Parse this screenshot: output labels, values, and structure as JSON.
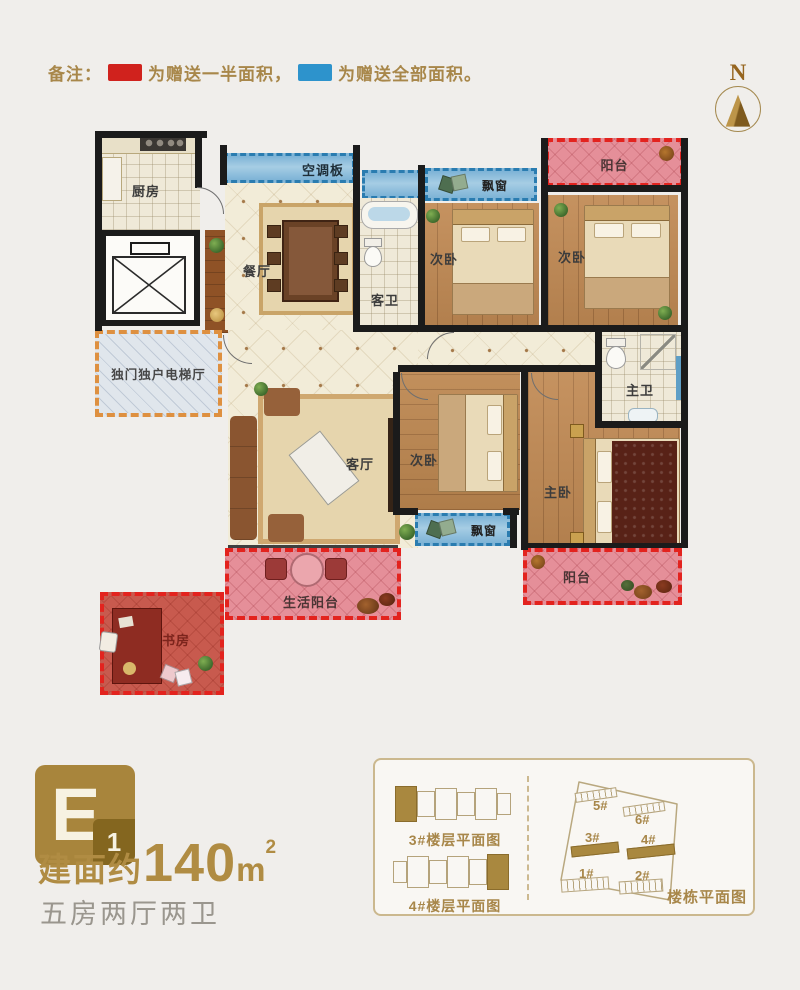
{
  "note": {
    "label": "备注：",
    "half": {
      "text": "为赠送一半面积，",
      "color": "#d0221d"
    },
    "full": {
      "text": "为赠送全部面积。",
      "color": "#2d93cc"
    }
  },
  "compass": {
    "letter": "N"
  },
  "plan": {
    "labels": {
      "kitchen": "厨房",
      "ac_panel": "空调板",
      "bay_window": "飘窗",
      "bay_window2": "飘窗",
      "balcony_top": "阳台",
      "balcony_bottom": "阳台",
      "bedroom_a": "次卧",
      "bedroom_b": "次卧",
      "bedroom_c": "次卧",
      "guest_bath": "客卫",
      "dining": "餐厅",
      "living": "客厅",
      "elevator_hall": "独门独户电梯厅",
      "master_bath": "主卫",
      "master_bedroom": "主卧",
      "life_balcony": "生活阳台",
      "study": "书房"
    },
    "colors": {
      "gift_half_border": "#e3231e",
      "gift_full_border": "#2a7cb0",
      "balcony_fill": "#e58f99",
      "study_fill": "#c85a4e",
      "bay_fill": "#8fc0dc",
      "hall_fill": "#e0e6ec",
      "hall_border": "#de9040",
      "gold_accent": "#a8874a"
    }
  },
  "unit": {
    "badge_letter": "E",
    "badge_number": "1",
    "area_prefix": "建面约",
    "area_value": "140",
    "area_unit": "m",
    "area_exp": "2",
    "rooms_desc": "五房两厅两卫"
  },
  "minimap": {
    "floor3_label": "3#楼层平面图",
    "floor4_label": "4#楼层平面图",
    "site_title": "楼栋平面图",
    "sites": [
      {
        "id": "5#"
      },
      {
        "id": "6#"
      },
      {
        "id": "3#"
      },
      {
        "id": "4#"
      },
      {
        "id": "1#"
      },
      {
        "id": "2#"
      }
    ]
  }
}
